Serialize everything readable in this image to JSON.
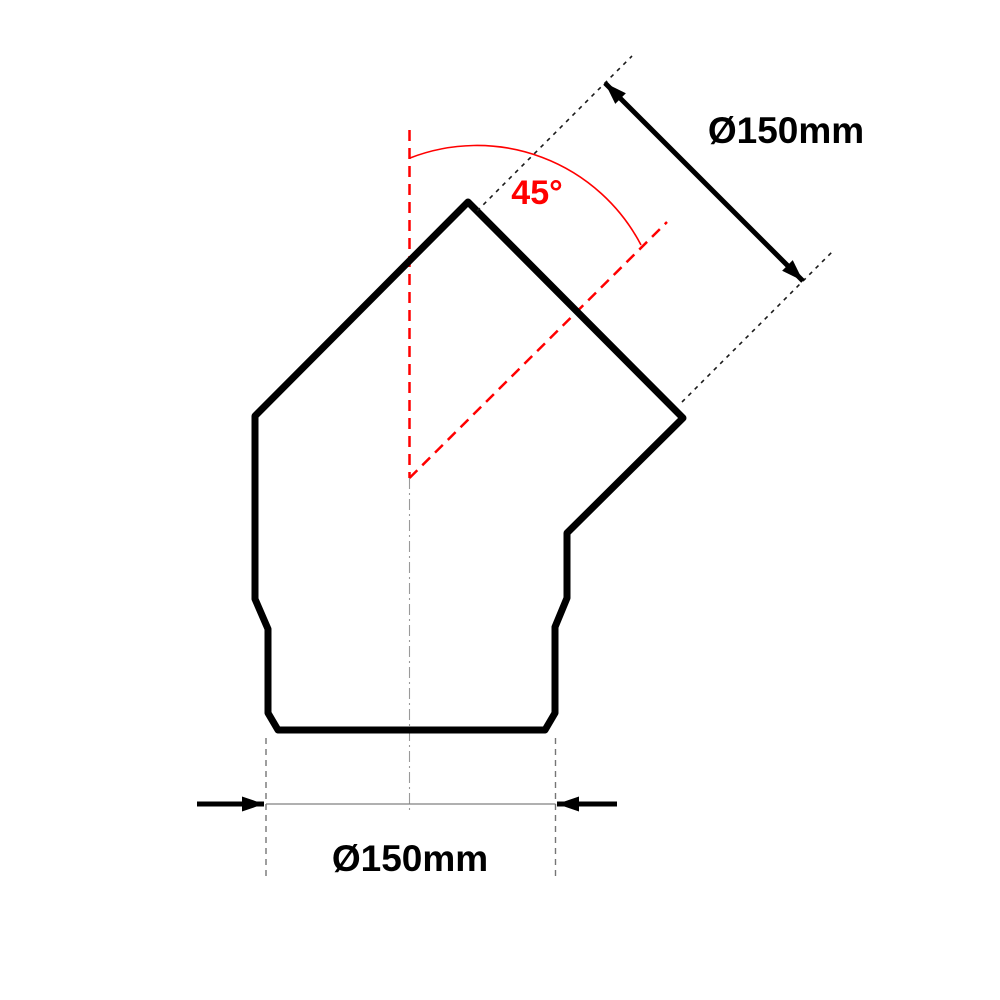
{
  "diagram": {
    "kind": "technical-dimension-drawing",
    "labels": {
      "top_diameter": "Ø150mm",
      "bottom_diameter": "Ø150mm",
      "angle": "45°"
    },
    "measurements": {
      "diameter_mm": 150,
      "angle_deg": 45
    },
    "colors": {
      "outline_black": "#000000",
      "accent_red": "#ff0000",
      "dim_line_gray": "#808080",
      "extension_gray": "#757575",
      "centerline_gray": "#9a9a9a",
      "background": "#ffffff"
    }
  }
}
